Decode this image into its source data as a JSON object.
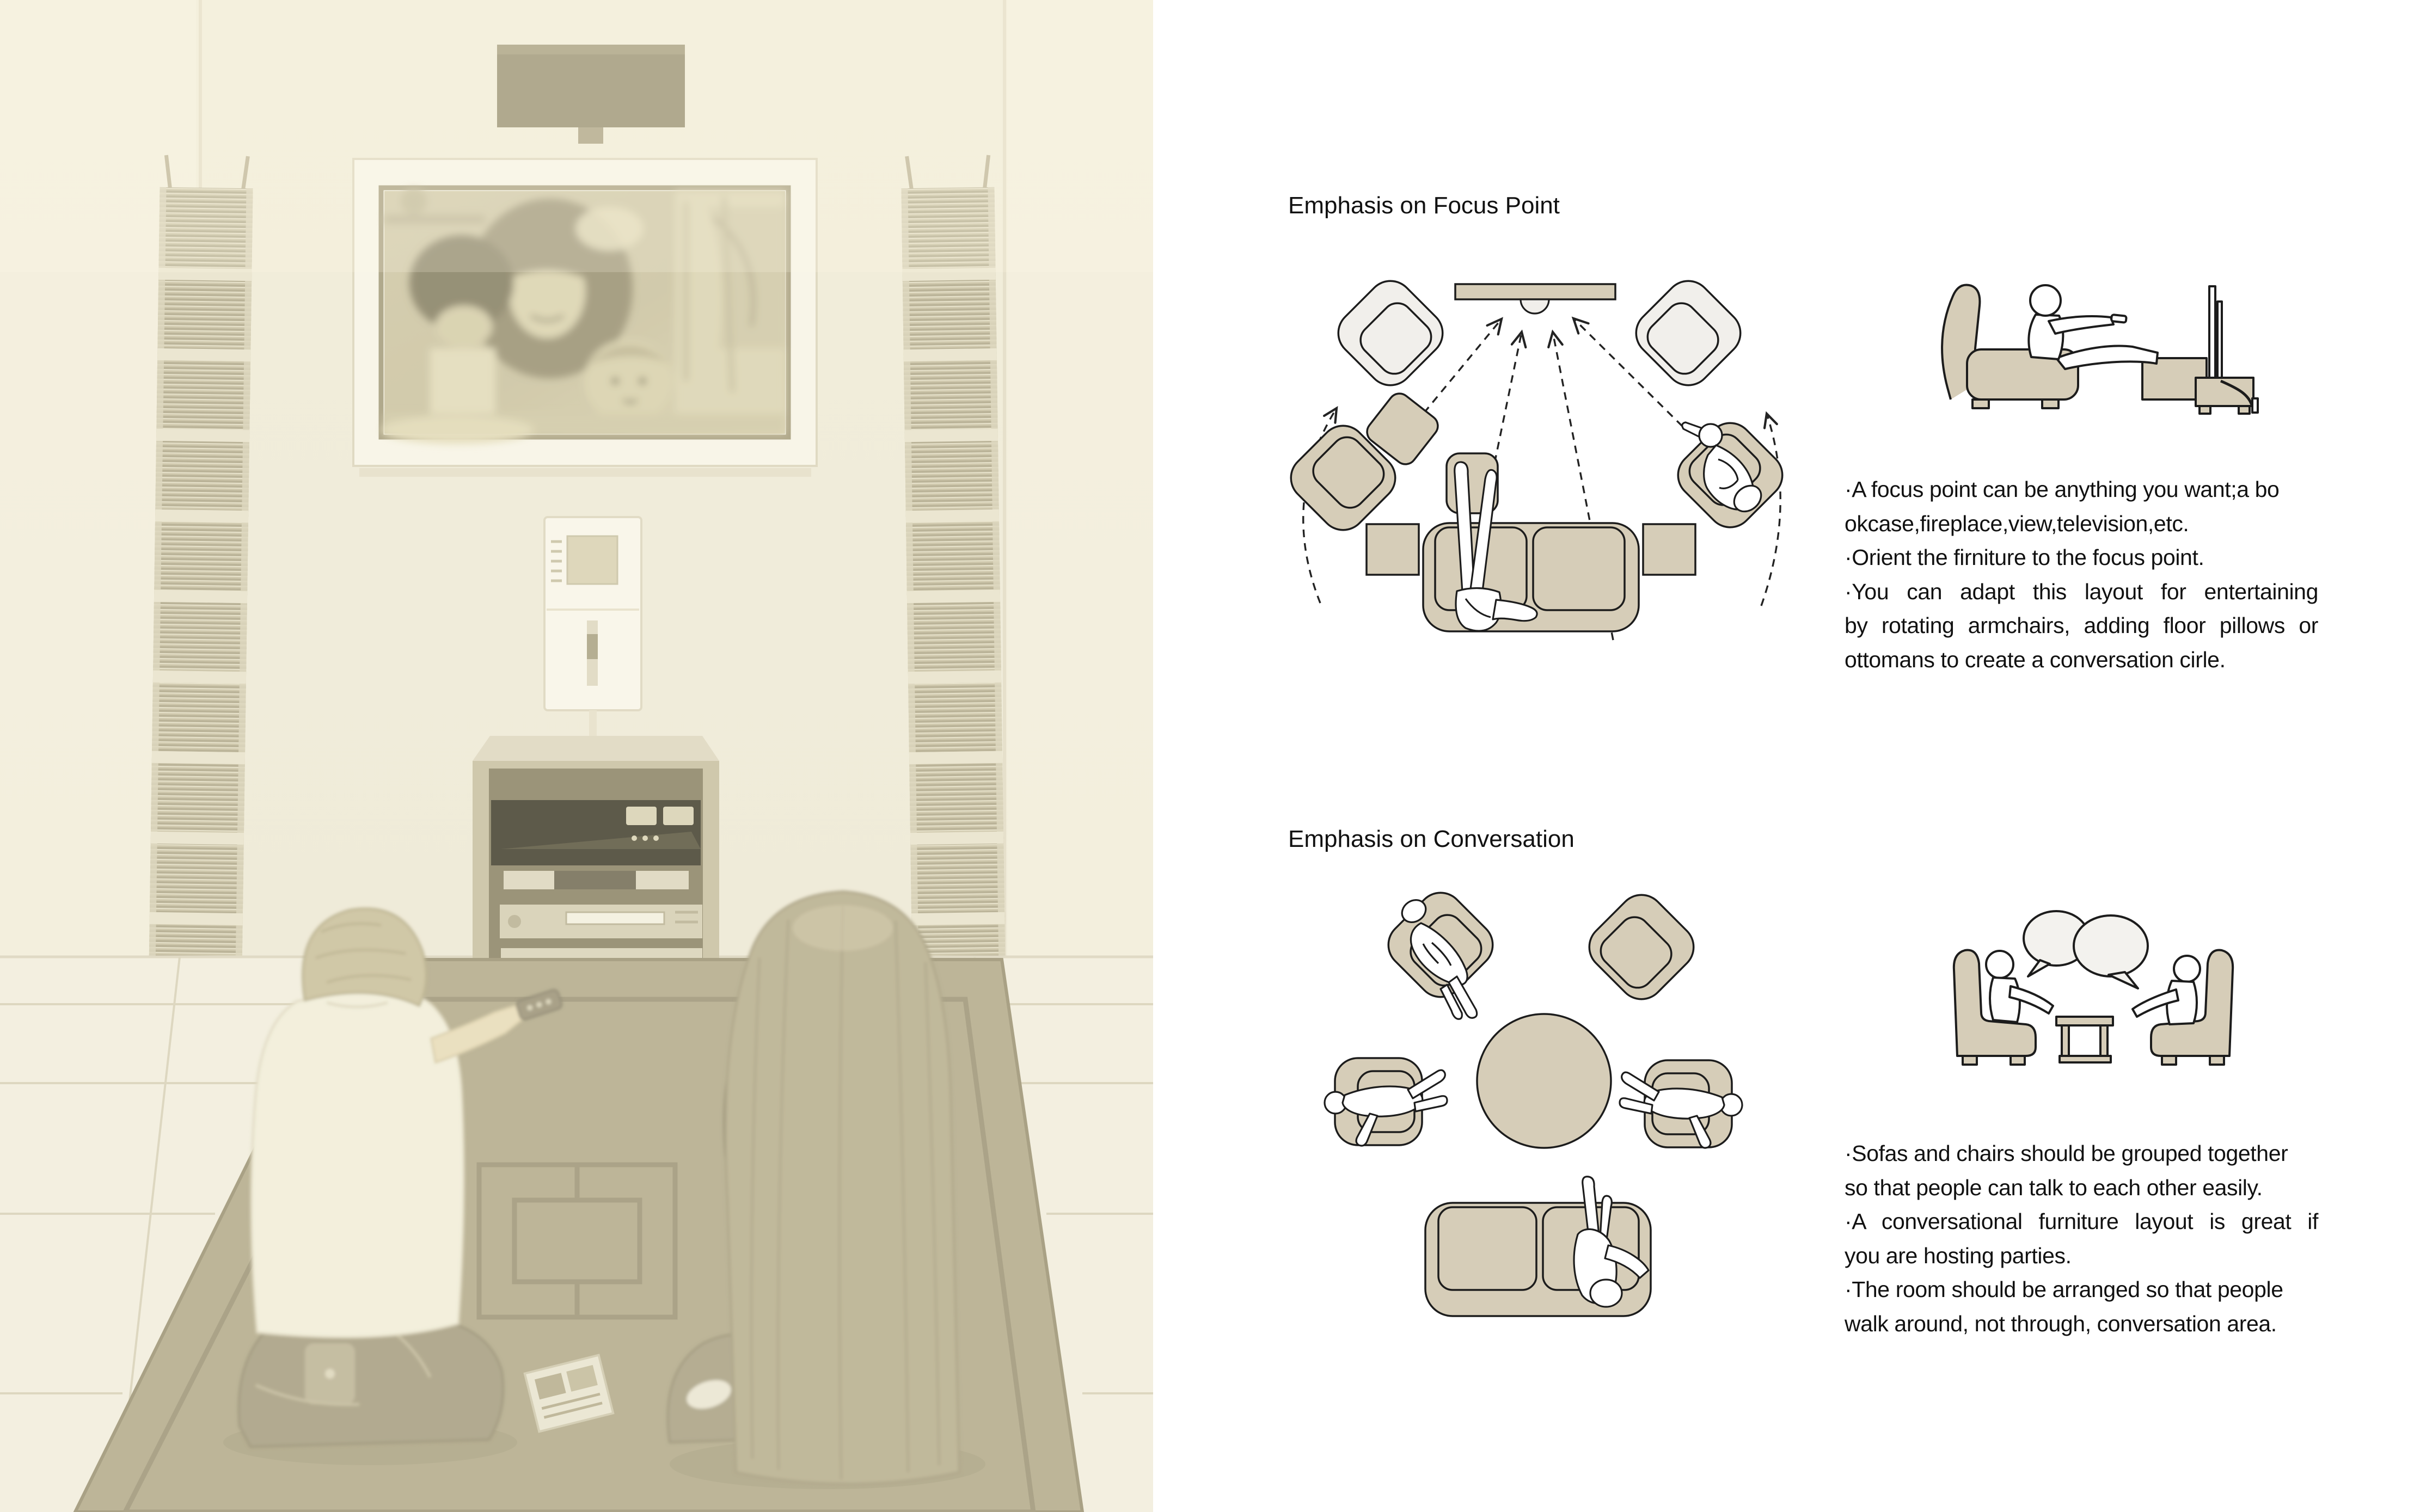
{
  "sections": [
    {
      "id": "focus",
      "title": "Emphasis on Focus Point",
      "notes": [
        "·A focus point can be anything you want;a bo",
        "okcase,fireplace,view,television,etc.",
        "·Orient the firniture to the focus point.",
        "·You can adapt this layout for entertaining",
        "by rotating armchairs, adding floor pillows or",
        "ottomans to create a conversation cirle."
      ]
    },
    {
      "id": "conversation",
      "title": "Emphasis on Conversation",
      "notes": [
        "·Sofas and chairs should be grouped together",
        "so that people can talk to each other easily.",
        "·A conversational furniture layout is great if",
        "you are hosting parties.",
        "·The room should be arranged so that people",
        "walk around, not through, conversation area."
      ]
    }
  ],
  "icons": [
    "armchair-top-icon",
    "ottoman-icon",
    "sofa-top-icon",
    "side-table-icon",
    "headrest-icon",
    "coffee-table-icon",
    "person-figure-icon",
    "sightline-arrow-icon",
    "rotation-arrow-icon",
    "tv-focus-bar-icon",
    "recliner-side-icon",
    "tv-side-icon",
    "speech-bubble-icon",
    "living-room-photo",
    "wall-speaker-icon",
    "cd-tower-icon",
    "tv-cabinet-icon",
    "wall-control-icon",
    "rug-icon"
  ],
  "palette": {
    "page_background": "#ffffff",
    "text": "#111111",
    "diagram_outline": "#1c1c1c",
    "furniture_tan": "#d6cdb8",
    "furniture_light": "#f1efeb",
    "speech_bubble_fill": "#f3f2ee",
    "photo_sepia_background": "#f0ecdb",
    "photo_rug": "#b2aa8b",
    "photo_speaker": "#8c8566",
    "photo_cabinet": "#c7c0a3"
  }
}
